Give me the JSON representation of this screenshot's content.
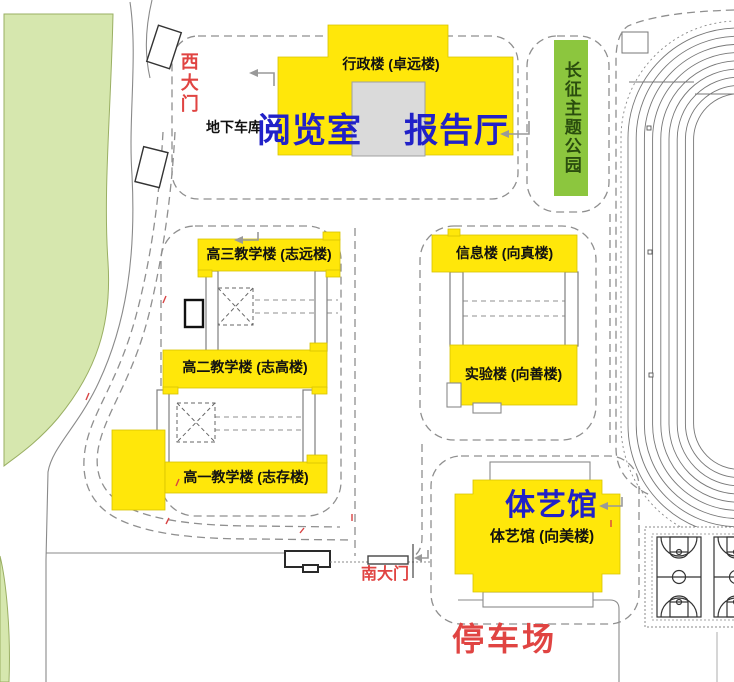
{
  "campus_map": {
    "west_gate": "西大门",
    "south_gate": "南大门",
    "underground_garage": "地下车库",
    "admin_building": "行政楼 (卓远楼)",
    "reading_room": "阅览室",
    "lecture_hall": "报告厅",
    "theme_park": "长征主题公园",
    "grade3_building": "高三教学楼 (志远楼)",
    "info_building": "信息楼 (向真楼)",
    "grade2_building": "高二教学楼 (志高楼)",
    "lab_building": "实验楼 (向善楼)",
    "grade1_building": "高一教学楼 (志存楼)",
    "gym_highlight": "体艺馆",
    "gym_building": "体艺馆 (向美楼)",
    "parking_lot": "停车场",
    "colors": {
      "building_yellow": "#FFE70A",
      "highlight_blue": "#2121C8",
      "gate_red": "#E04442",
      "park_green": "#8CC63E",
      "lawn_green": "#D6E7AE"
    }
  }
}
